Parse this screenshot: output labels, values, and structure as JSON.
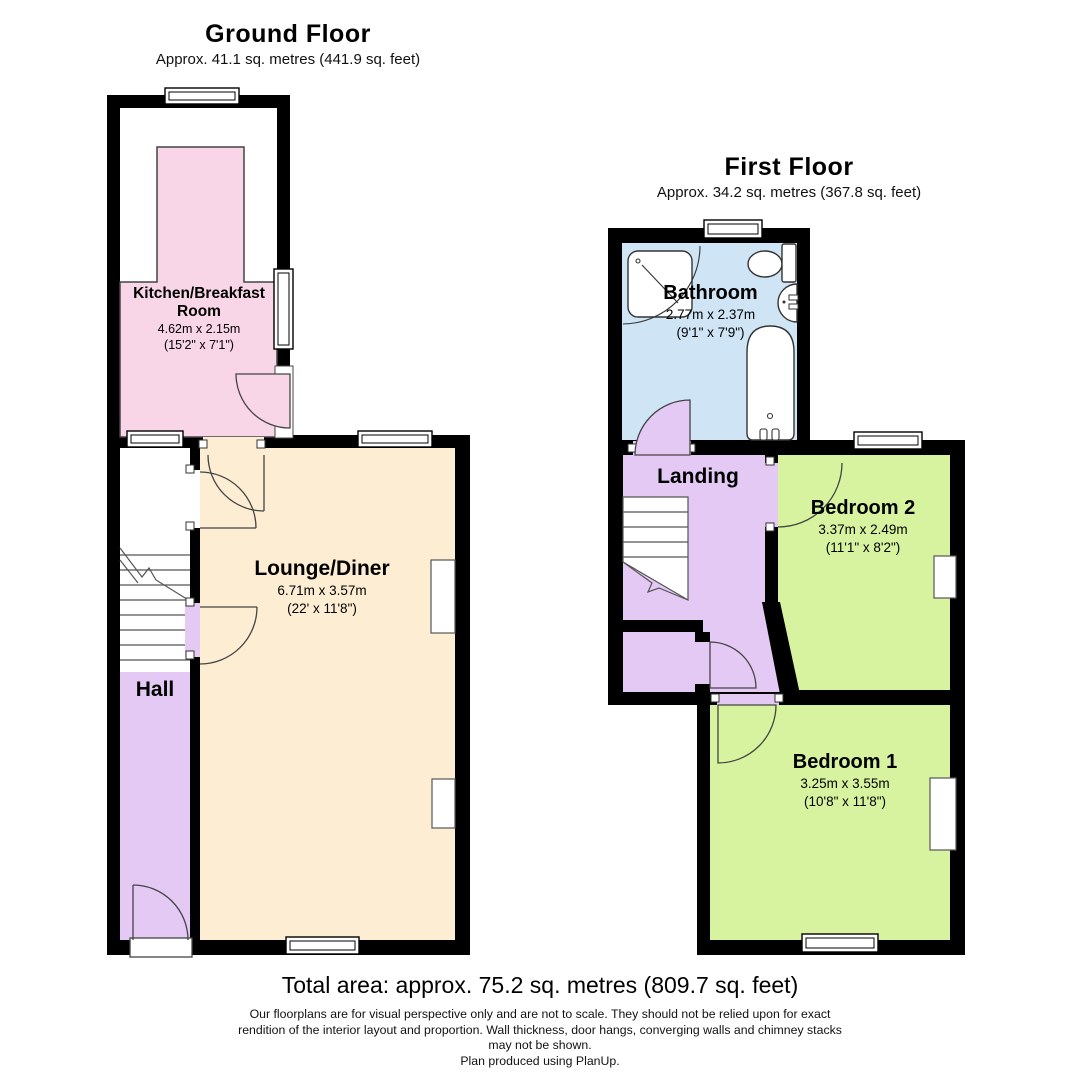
{
  "ground_floor": {
    "title": "Ground Floor",
    "subtitle": "Approx. 41.1 sq. metres (441.9 sq. feet)",
    "rooms": {
      "kitchen": {
        "name_line1": "Kitchen/Breakfast",
        "name_line2": "Room",
        "dims_metric": "4.62m x 2.15m",
        "dims_imperial": "(15'2\" x 7'1\")"
      },
      "lounge": {
        "name": "Lounge/Diner",
        "dims_metric": "6.71m x 3.57m",
        "dims_imperial": "(22' x 11'8\")"
      },
      "hall": {
        "name": "Hall"
      }
    }
  },
  "first_floor": {
    "title": "First Floor",
    "subtitle": "Approx. 34.2 sq. metres (367.8 sq. feet)",
    "rooms": {
      "bathroom": {
        "name": "Bathroom",
        "dims_metric": "2.77m x 2.37m",
        "dims_imperial": "(9'1\" x 7'9\")"
      },
      "landing": {
        "name": "Landing"
      },
      "bedroom2": {
        "name": "Bedroom 2",
        "dims_metric": "3.37m x 2.49m",
        "dims_imperial": "(11'1\" x 8'2\")"
      },
      "bedroom1": {
        "name": "Bedroom 1",
        "dims_metric": "3.25m x 3.55m",
        "dims_imperial": "(10'8\" x 11'8\")"
      }
    }
  },
  "footer": {
    "total_area": "Total area: approx. 75.2 sq. metres (809.7 sq. feet)",
    "disclaimer_line1": "Our floorplans are for visual perspective only and are not to scale.  They should not be relied upon for exact",
    "disclaimer_line2": "rendition of the interior layout and proportion.  Wall thickness, door hangs, converging walls and chimney stacks",
    "disclaimer_line3": "may not be shown.",
    "credit": "Plan produced using PlanUp."
  },
  "colors": {
    "kitchen_pink": "#f8d6e8",
    "lounge_cream": "#fdeed3",
    "hall_purple": "#e3c9f3",
    "bathroom_blue": "#cfe5f6",
    "bedroom_green": "#d7f3a0",
    "wall_black": "#000000",
    "void_white": "#ffffff"
  }
}
